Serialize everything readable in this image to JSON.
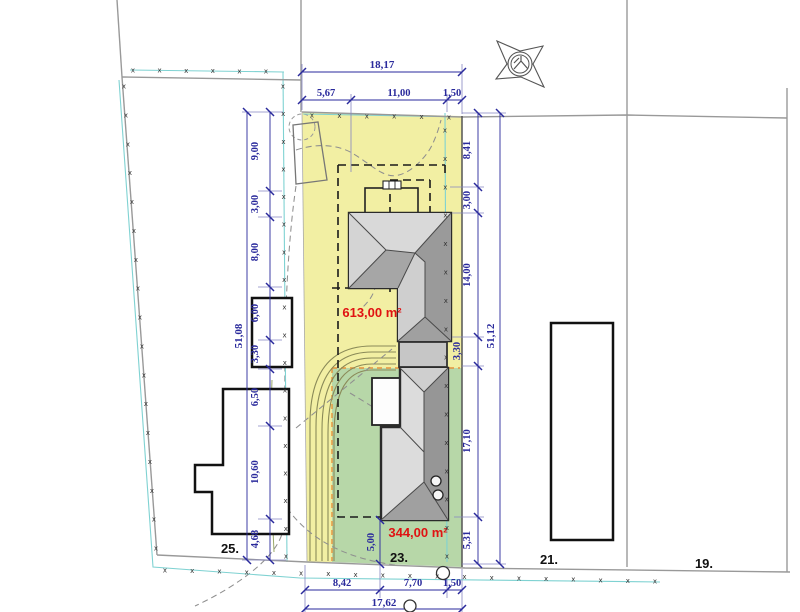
{
  "drawing": {
    "type": "site-plan",
    "area_labels": {
      "upper": "613,00 m²",
      "lower": "344,00 m²"
    },
    "plot_labels": {
      "p25": "25.",
      "p23": "23.",
      "p21": "21.",
      "p19": "19."
    },
    "dims": {
      "top_overall": "18,17",
      "top_chain": [
        "5,67",
        "11,00",
        "1,50"
      ],
      "left_overall": "51,08",
      "left_chain": [
        "9,00",
        "3,00",
        "8,00",
        "6,00",
        "3,30",
        "6,50",
        "10,60",
        "4,68"
      ],
      "right_overall": "51,12",
      "right_chain": [
        "8,41",
        "3,00",
        "14,00",
        "3,30",
        "17,10",
        "5,31"
      ],
      "bottom_overall": "17,62",
      "bottom_chain": [
        "8,42",
        "7,70",
        "1,50"
      ],
      "south_gap": "5,00"
    },
    "marks": {
      "fence_glyph": "x"
    },
    "colors": {
      "zone_yellow": "#f2efa3",
      "zone_green": "#b7d7a8",
      "dim_blue": "#2a2a9c",
      "area_red": "#e01212",
      "fence_cyan": "#7fd2d2",
      "zone_border_orange": "#e5923c",
      "roof_light": "#dcdcdc",
      "roof_dark": "#969696"
    }
  }
}
